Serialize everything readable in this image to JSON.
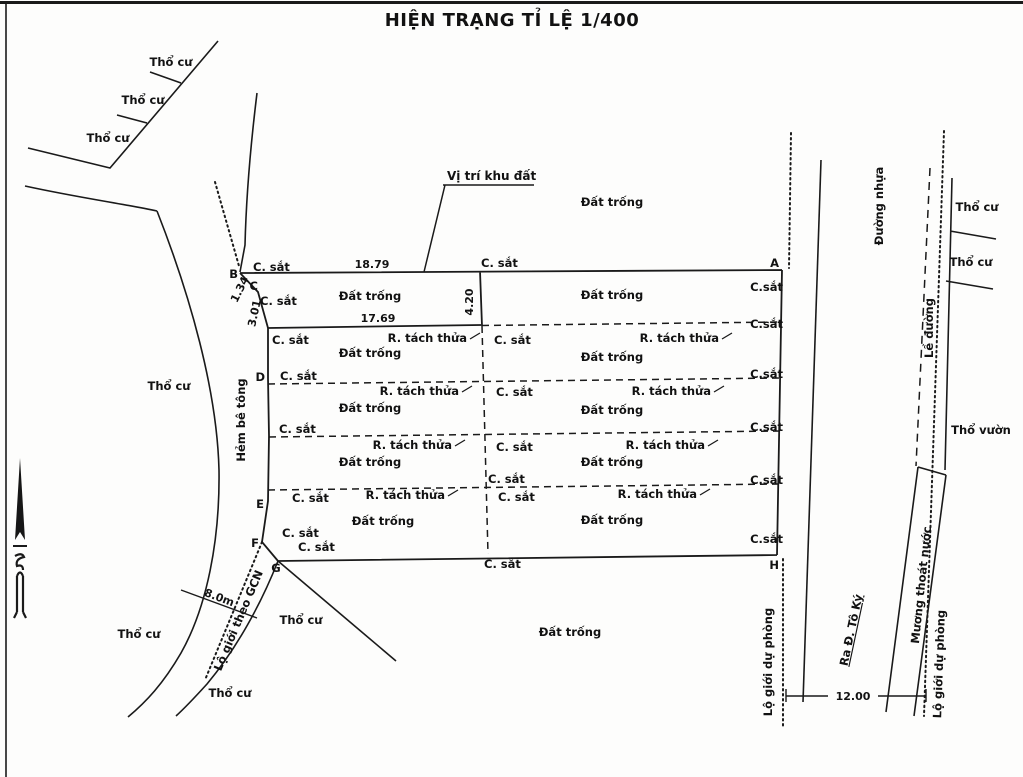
{
  "title": "HIỆN TRẠNG TỈ LỆ 1/400",
  "map": {
    "callout": {
      "vi_tri_khu_dat": "Vị trí khu đất"
    },
    "area_labels": {
      "dat_trong": "Đất trống",
      "tho_cu": "Thổ cư",
      "tho_vuon": "Thổ vườn"
    },
    "boundary_labels": {
      "c_sat": "C. sắt",
      "c_sat_tight": "C.sắt",
      "r_tach_thua": "R. tách thửa"
    },
    "road_labels": {
      "hem_be_tong": "Hẻm bê tông",
      "duong_nhua": "Đường nhựa",
      "le_duong": "Lề đường",
      "muong_thoat_nuoc": "Mương thoát nước",
      "lo_gioi_du_phong": "Lộ giới dự phòng",
      "lo_gioi_theo_gcn": "Lộ giới theo GCN",
      "ra_duong_to_ky": "Ra Đ. Tô Ký"
    },
    "measurements": {
      "edge_top": "18.79",
      "edge_second": "17.69",
      "width_center": "4.20",
      "segment_bc": "1.34",
      "segment_cd": "3.01",
      "alley_width": "8.0m",
      "road_width": "12.00"
    },
    "points": {
      "a": "A",
      "b": "B",
      "c": "C",
      "d": "D",
      "e": "E",
      "f": "F",
      "g": "G",
      "h": "H"
    }
  }
}
